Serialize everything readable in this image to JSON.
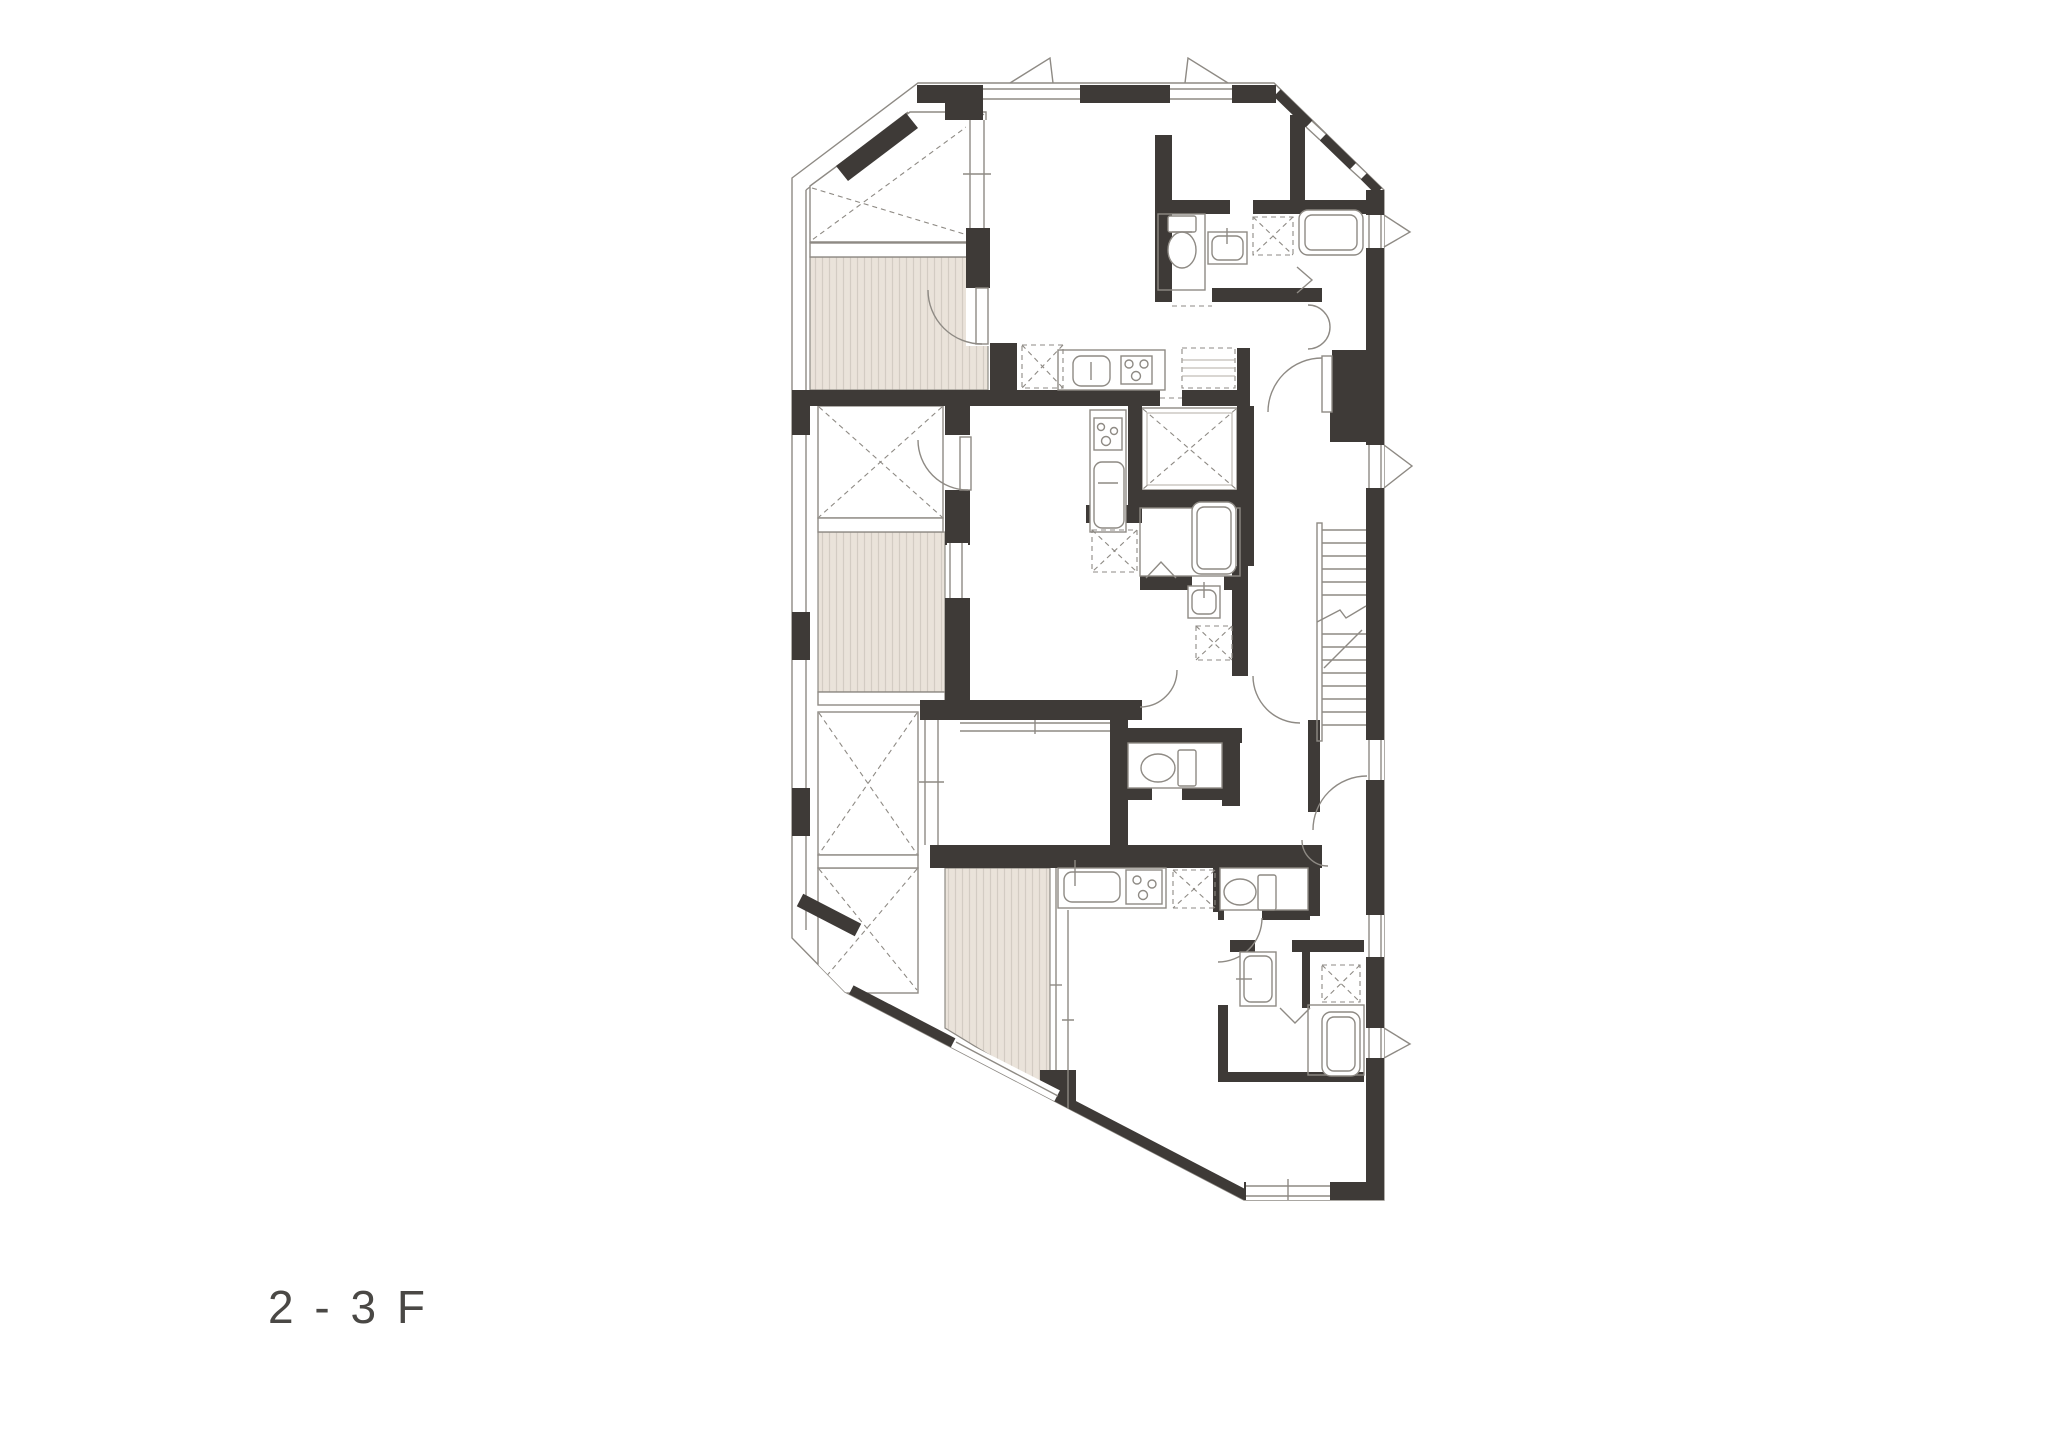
{
  "floor_label": "2 - 3 F",
  "palette": {
    "wall": "#3e3a37",
    "line": "#8e8a84",
    "line_light": "#b3ada6",
    "balcony_fill": "#eae3da",
    "balcony_stripe": "#d3ccc3",
    "label_text": "#4a4845",
    "background": "#ffffff"
  },
  "drawing": {
    "type": "architectural-floor-plan",
    "feature_icons": [
      "balcony-deck",
      "void-x-shaft",
      "elevator-shaft-x",
      "staircase",
      "door-swing-arc",
      "window-double-line",
      "toilet",
      "kitchen-sink",
      "stove-burners",
      "bathtub",
      "vanity-sink",
      "refrigerator-dashed-box",
      "service-box-x",
      "folding-door-chevron",
      "wall-solid",
      "stair-break-line"
    ],
    "counts": {
      "balconies": 3,
      "void_shafts": 5,
      "toilets": 3,
      "bathtubs": 3,
      "kitchen_counters": 3,
      "vanities": 2,
      "door_arcs": 10
    }
  }
}
